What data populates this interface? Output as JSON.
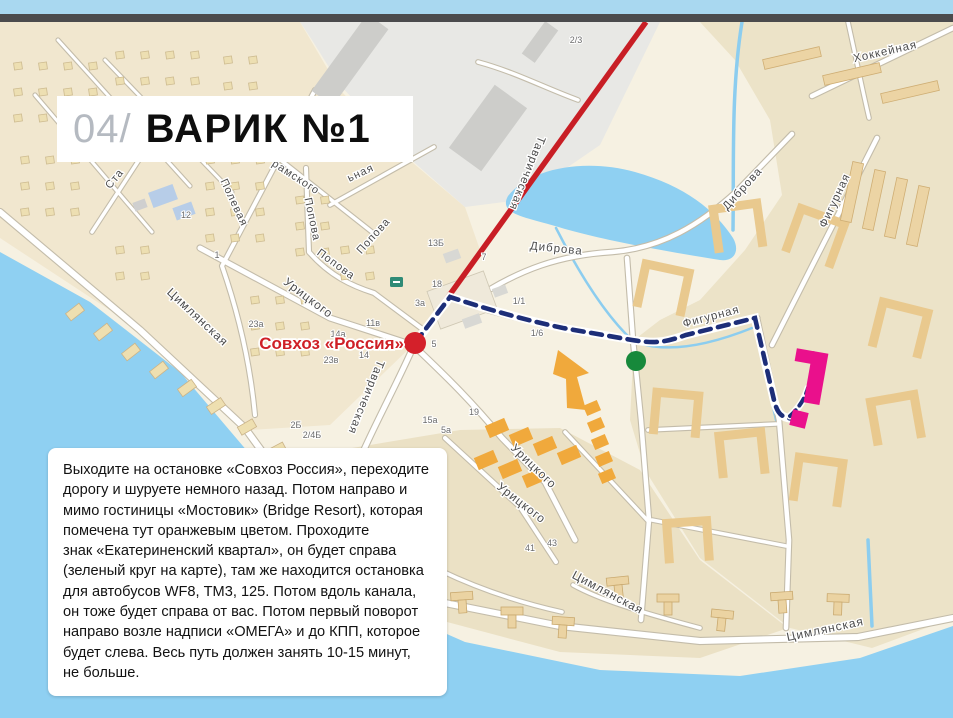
{
  "header": {
    "strip_color": "#a9d8f0",
    "bar_color": "#4b4b4d"
  },
  "title": {
    "index": "04/",
    "name": "ВАРИК №1"
  },
  "directions": {
    "text": "Выходите на остановке «Совхоз Россия», переходите\nдорогу и шуруете немного назад. Потом направо и\nмимо гостиницы «Мостовик» (Bridge Resort), которая\nпомечена тут оранжевым цветом. Проходите\nзнак «Екатериненский квартал», он будет справа\n(зеленый круг на карте), там же находится остановка\nдля автобусов WF8, ТМ3, 125. Потом вдоль канала,\nон тоже будет справа от вас. Потом первый поворот\nнаправо возле надписи «ОМЕГА» и до КПП, которое\nбудет слева. Весь путь должен занять 10-15 минут,\nне больше."
  },
  "map": {
    "stop_label": "Совхоз «Россия»",
    "markers": {
      "bus_stop": {
        "shape": "red-dot",
        "label": "Совхоз «Россия»"
      },
      "quarter_sign": {
        "shape": "green-dot"
      },
      "hotel_pointer": {
        "shape": "orange-arrow"
      },
      "destination": {
        "shape": "pink-building"
      }
    },
    "colors": {
      "water": "#8fd0f2",
      "bus_route": "#c81e25",
      "walk_route": "#1d2e78",
      "bus_stop_dot": "#d4202a",
      "sign_dot": "#17893b",
      "hotel_orange": "#f0a93c",
      "destination_pink": "#ea108c",
      "stop_label": "#cf1f26",
      "street_label": "#4c4c4c"
    },
    "street_labels": [
      {
        "text": "Цимлянская",
        "x": 195,
        "y": 320,
        "rot": 43,
        "size": 12
      },
      {
        "text": "Цимлянская",
        "x": 606,
        "y": 596,
        "rot": 28,
        "size": 12
      },
      {
        "text": "Цимлянская",
        "x": 826,
        "y": 633,
        "rot": -12,
        "size": 12
      },
      {
        "text": "Урицкого",
        "x": 306,
        "y": 301,
        "rot": 37,
        "size": 12
      },
      {
        "text": "Урицкого",
        "x": 531,
        "y": 469,
        "rot": 44,
        "size": 12
      },
      {
        "text": "Урицкого",
        "x": 519,
        "y": 506,
        "rot": 38,
        "size": 12
      },
      {
        "text": "Попова",
        "x": 309,
        "y": 220,
        "rot": 78,
        "size": 11
      },
      {
        "text": "Попова",
        "x": 334,
        "y": 267,
        "rot": 36,
        "size": 11
      },
      {
        "text": "Попова",
        "x": 376,
        "y": 238,
        "rot": -48,
        "size": 11
      },
      {
        "text": "Полевая",
        "x": 231,
        "y": 204,
        "rot": 65,
        "size": 11
      },
      {
        "text": "рамского",
        "x": 294,
        "y": 180,
        "rot": 33,
        "size": 11
      },
      {
        "text": "Ста",
        "x": 117,
        "y": 181,
        "rot": -50,
        "size": 11
      },
      {
        "text": "ьная",
        "x": 362,
        "y": 176,
        "rot": -25,
        "size": 11
      },
      {
        "text": "Таврическая",
        "x": 524,
        "y": 172,
        "rot": 112,
        "size": 11.5
      },
      {
        "text": "Таврическая",
        "x": 363,
        "y": 396,
        "rot": 112,
        "size": 11.5
      },
      {
        "text": "Диброва",
        "x": 556,
        "y": 252,
        "rot": 6,
        "size": 11.5
      },
      {
        "text": "Диброва",
        "x": 745,
        "y": 191,
        "rot": -48,
        "size": 11.5
      },
      {
        "text": "Фигурная",
        "x": 712,
        "y": 320,
        "rot": -15,
        "size": 11.5
      },
      {
        "text": "Фигурная",
        "x": 838,
        "y": 202,
        "rot": -65,
        "size": 11.5
      },
      {
        "text": "Хоккейная",
        "x": 886,
        "y": 55,
        "rot": -13,
        "size": 11.5
      }
    ],
    "house_numbers": [
      {
        "text": "2/3",
        "x": 576,
        "y": 43
      },
      {
        "text": "12",
        "x": 186,
        "y": 218
      },
      {
        "text": "1",
        "x": 217,
        "y": 258
      },
      {
        "text": "13Б",
        "x": 436,
        "y": 246
      },
      {
        "text": "7",
        "x": 484,
        "y": 260
      },
      {
        "text": "18",
        "x": 437,
        "y": 287
      },
      {
        "text": "3а",
        "x": 420,
        "y": 306
      },
      {
        "text": "5",
        "x": 434,
        "y": 347
      },
      {
        "text": "1/1",
        "x": 519,
        "y": 304
      },
      {
        "text": "1/6",
        "x": 537,
        "y": 336
      },
      {
        "text": "23а",
        "x": 256,
        "y": 327
      },
      {
        "text": "14а",
        "x": 338,
        "y": 337
      },
      {
        "text": "11в",
        "x": 373,
        "y": 326
      },
      {
        "text": "14",
        "x": 364,
        "y": 358
      },
      {
        "text": "23в",
        "x": 331,
        "y": 363
      },
      {
        "text": "2Б",
        "x": 296,
        "y": 428
      },
      {
        "text": "2/4Б",
        "x": 312,
        "y": 438
      },
      {
        "text": "19",
        "x": 474,
        "y": 415
      },
      {
        "text": "5а",
        "x": 446,
        "y": 433
      },
      {
        "text": "15а",
        "x": 430,
        "y": 423
      },
      {
        "text": "41",
        "x": 530,
        "y": 551
      },
      {
        "text": "43",
        "x": 552,
        "y": 546
      }
    ]
  }
}
